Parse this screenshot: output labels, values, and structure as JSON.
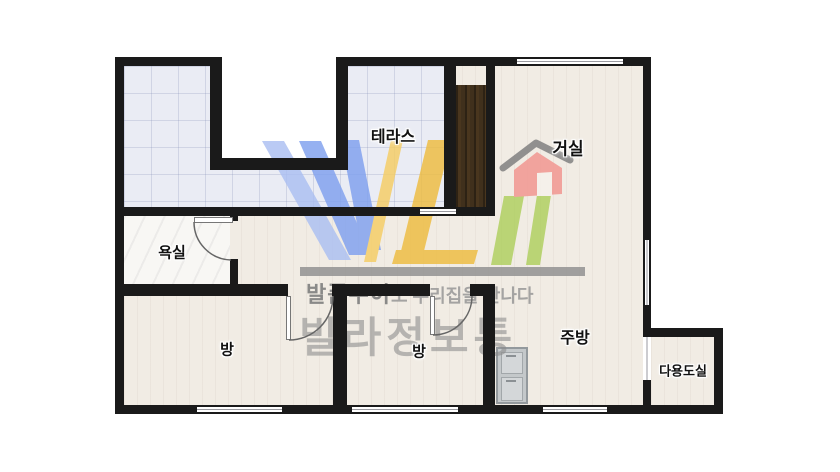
{
  "plan": {
    "rooms": [
      {
        "id": "terrace",
        "label": "테라스"
      },
      {
        "id": "living",
        "label": "거실"
      },
      {
        "id": "bathroom",
        "label": "욕실"
      },
      {
        "id": "room1",
        "label": "방"
      },
      {
        "id": "room2",
        "label": "방"
      },
      {
        "id": "kitchen",
        "label": "주방"
      },
      {
        "id": "utility",
        "label": "다용도실"
      }
    ]
  },
  "watermark": {
    "slogan_bold": "발품두이",
    "slogan_rest": "도 우리집을 만나다",
    "brand": "빌라정보통"
  },
  "palette": {
    "wall": "#1a1a1a",
    "floor": "#f1ece4",
    "tile": "#eaecf4",
    "blue": "#7fa0ef",
    "blue_light": "#abbff2",
    "yellow": "#eebc3f",
    "yellow_light": "#f5cd63",
    "green": "#aecf5d",
    "red": "#f2948e",
    "roof": "#7d7d7d",
    "bar": "#8f8f8f"
  }
}
